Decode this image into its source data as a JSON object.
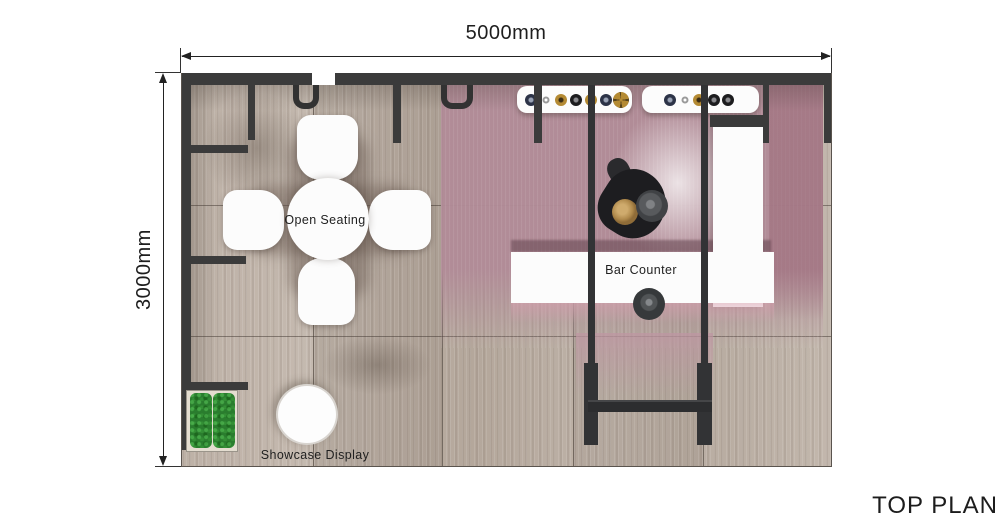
{
  "title": "TOP PLAN",
  "dimensions": {
    "width": "5000mm",
    "height": "3000mm"
  },
  "labels": {
    "open_seating": "Open Seating",
    "bar_counter": "Bar Counter",
    "showcase_display": "Showcase Display"
  },
  "equipment": {
    "machine_a_knobs": [
      "navy",
      "white",
      "gold",
      "black",
      "gold",
      "navy",
      "gold-fan"
    ],
    "machine_b_knobs": [
      "navy",
      "white",
      "gold",
      "black",
      "black"
    ]
  },
  "colors": {
    "wall": "#3b3b3b",
    "floor_wood": "#b6a89c",
    "carpet_pink": "#b18b97",
    "moss_green": "#2a7d2e",
    "furniture_white": "#fcfcfc",
    "annotation_text": "#222222"
  }
}
